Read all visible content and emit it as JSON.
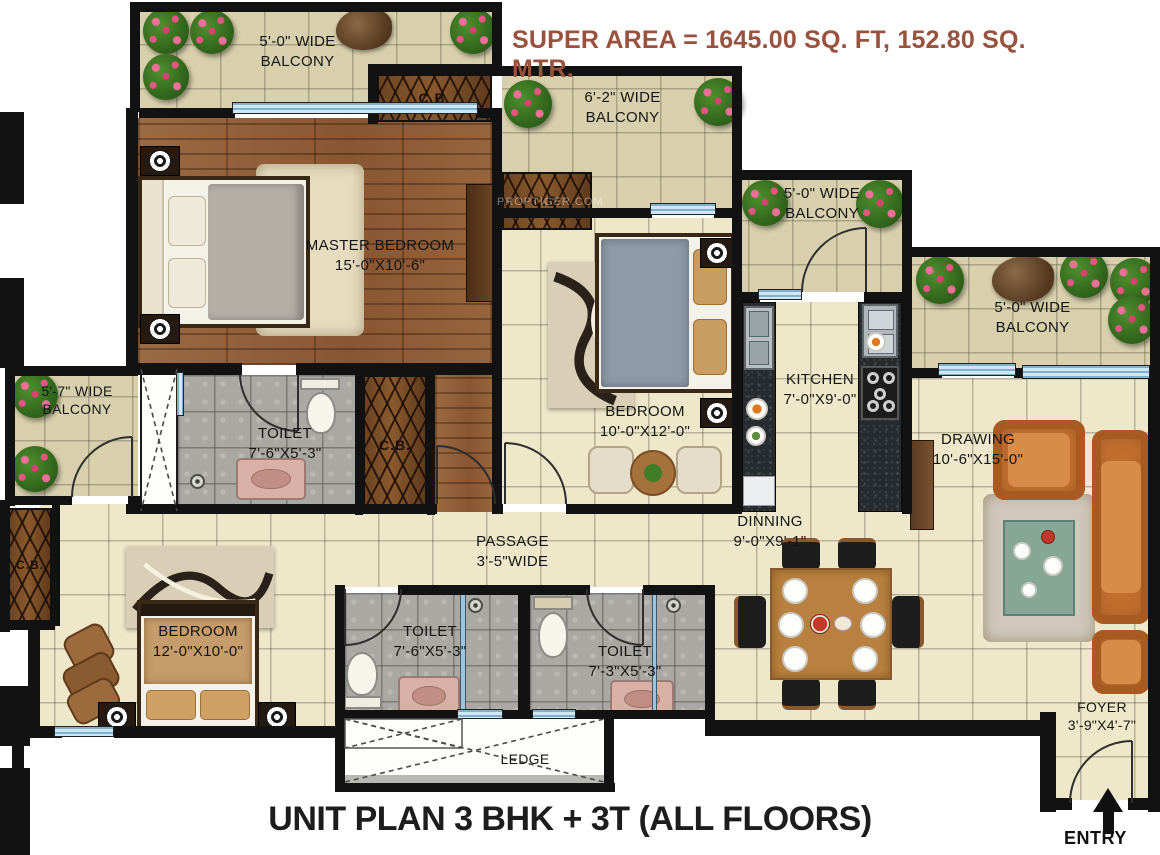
{
  "header": {
    "super_area": "SUPER AREA = 1645.00 SQ. FT, 152.80 SQ. MTR."
  },
  "footer": {
    "plan_title": "UNIT PLAN 3 BHK + 3T (ALL FLOORS)",
    "entry_label": "ENTRY"
  },
  "rooms": {
    "master_bedroom": {
      "name": "MASTER BEDROOM",
      "dims": "15'-0\"X10'-6\""
    },
    "bedroom2": {
      "name": "BEDROOM",
      "dims": "10'-0\"X12'-0\""
    },
    "bedroom3": {
      "name": "BEDROOM",
      "dims": "12'-0\"X10'-0\""
    },
    "kitchen": {
      "name": "KITCHEN",
      "dims": "7'-0\"X9'-0\""
    },
    "drawing": {
      "name": "DRAWING",
      "dims": "10'-6\"X15'-0\""
    },
    "dinning": {
      "name": "DINNING",
      "dims": "9'-0\"X9'-1\""
    },
    "toilet_master": {
      "name": "TOILET",
      "dims": "7'-6\"X5'-3\""
    },
    "toilet2": {
      "name": "TOILET",
      "dims": "7'-6\"X5'-3\""
    },
    "toilet3": {
      "name": "TOILET",
      "dims": "7'-3\"X5'-3\""
    },
    "passage": {
      "name": "PASSAGE",
      "dims": "3'-5\"WIDE"
    },
    "foyer": {
      "name": "FOYER",
      "dims": "3'-9\"X4'-7\""
    },
    "ledge": {
      "name": "LEDGE"
    }
  },
  "balconies": {
    "top_left": {
      "size": "5'-0\" WIDE",
      "word": "BALCONY"
    },
    "upper_middle": {
      "size": "6'-2\" WIDE",
      "word": "BALCONY"
    },
    "kitchen_side": {
      "size": "5'-0\" WIDE",
      "word": "BALCONY"
    },
    "right": {
      "size": "5'-0\" WIDE",
      "word": "BALCONY"
    },
    "left": {
      "size": "5'-7\" WIDE",
      "word": "BALCONY"
    }
  },
  "cupboard_label": "C.B.",
  "watermark": "PROPTIGER.COM",
  "colors": {
    "title_text": "#98523E",
    "wall": "#121212",
    "floor_tile": "#EFE7C9",
    "balcony_floor": "#D8D0AC",
    "wood_floor": "#92603A",
    "toilet_tile": "#A9A8A2",
    "granite": "#262B2F",
    "window": "#A9CFE4",
    "sofa": "#C06E2E"
  }
}
